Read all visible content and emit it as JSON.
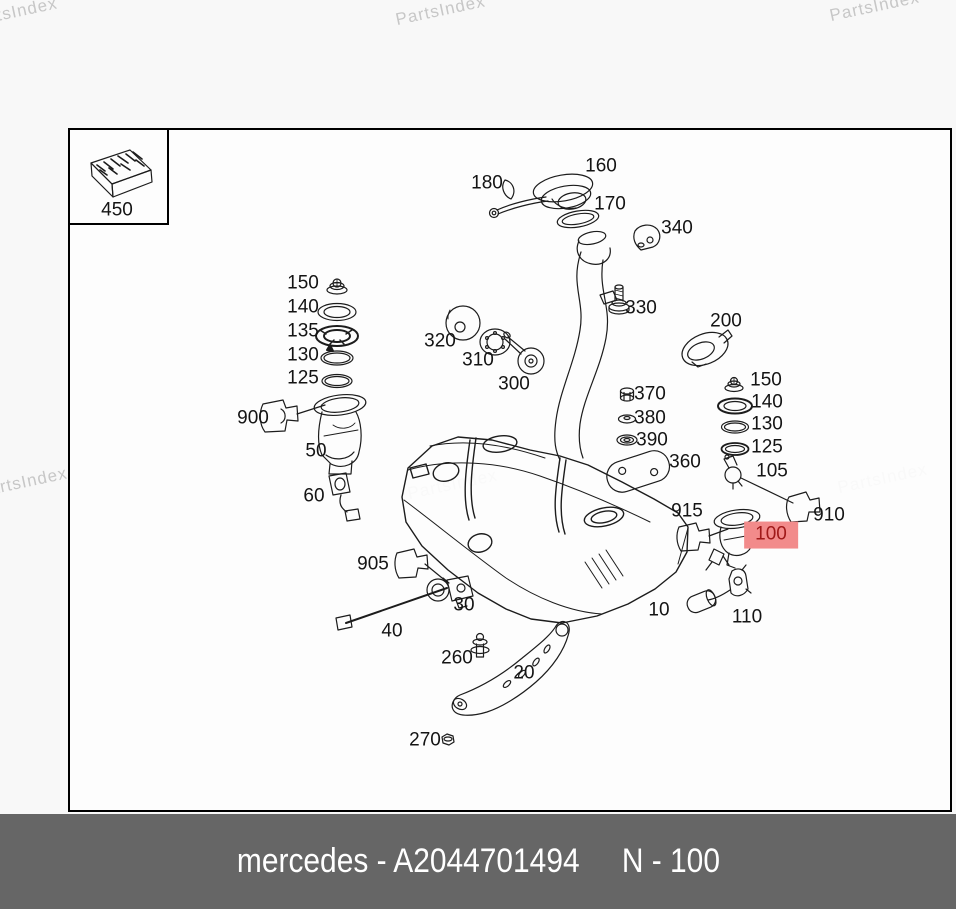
{
  "watermarks": {
    "text": "PartsIndex",
    "color": "#c7c7c7",
    "positions": [
      {
        "x": -30,
        "y": 12
      },
      {
        "x": 398,
        "y": 10
      },
      {
        "x": 832,
        "y": 6
      },
      {
        "x": -20,
        "y": 482
      },
      {
        "x": 410,
        "y": 484
      },
      {
        "x": 840,
        "y": 478
      }
    ]
  },
  "footer": {
    "left_text": "mercedes - A2044701494",
    "right_text": "N - 100",
    "background": "#666666",
    "text_color": "#ffffff"
  },
  "diagram": {
    "highlight": {
      "background": "#f28b8b",
      "text_color": "#a01a1a"
    },
    "labels": [
      {
        "id": "450",
        "text": "450",
        "x": 117,
        "y": 211
      },
      {
        "id": "180",
        "text": "180",
        "x": 487,
        "y": 184
      },
      {
        "id": "160",
        "text": "160",
        "x": 601,
        "y": 167
      },
      {
        "id": "170",
        "text": "170",
        "x": 610,
        "y": 205
      },
      {
        "id": "340",
        "text": "340",
        "x": 677,
        "y": 229
      },
      {
        "id": "150-left",
        "text": "150",
        "x": 303,
        "y": 284
      },
      {
        "id": "140-left",
        "text": "140",
        "x": 303,
        "y": 308
      },
      {
        "id": "135-left",
        "text": "135",
        "x": 303,
        "y": 332
      },
      {
        "id": "130-left",
        "text": "130",
        "x": 303,
        "y": 356
      },
      {
        "id": "125-left",
        "text": "125",
        "x": 303,
        "y": 379
      },
      {
        "id": "320",
        "text": "320",
        "x": 440,
        "y": 342
      },
      {
        "id": "310",
        "text": "310",
        "x": 478,
        "y": 361
      },
      {
        "id": "300",
        "text": "300",
        "x": 514,
        "y": 385
      },
      {
        "id": "330",
        "text": "330",
        "x": 641,
        "y": 309
      },
      {
        "id": "200",
        "text": "200",
        "x": 726,
        "y": 322
      },
      {
        "id": "370",
        "text": "370",
        "x": 650,
        "y": 395
      },
      {
        "id": "380",
        "text": "380",
        "x": 650,
        "y": 419
      },
      {
        "id": "390",
        "text": "390",
        "x": 652,
        "y": 441
      },
      {
        "id": "150-right",
        "text": "150",
        "x": 766,
        "y": 381
      },
      {
        "id": "140-right",
        "text": "140",
        "x": 767,
        "y": 403
      },
      {
        "id": "130-right",
        "text": "130",
        "x": 767,
        "y": 425
      },
      {
        "id": "125-right",
        "text": "125",
        "x": 767,
        "y": 448
      },
      {
        "id": "105",
        "text": "105",
        "x": 772,
        "y": 472
      },
      {
        "id": "900",
        "text": "900",
        "x": 253,
        "y": 419
      },
      {
        "id": "50",
        "text": "50",
        "x": 316,
        "y": 452
      },
      {
        "id": "360",
        "text": "360",
        "x": 685,
        "y": 463
      },
      {
        "id": "60",
        "text": "60",
        "x": 314,
        "y": 497
      },
      {
        "id": "915",
        "text": "915",
        "x": 687,
        "y": 512
      },
      {
        "id": "910",
        "text": "910",
        "x": 829,
        "y": 516
      },
      {
        "id": "100",
        "text": "100",
        "x": 771,
        "y": 535,
        "highlighted": true
      },
      {
        "id": "905",
        "text": "905",
        "x": 373,
        "y": 565
      },
      {
        "id": "30",
        "text": "30",
        "x": 464,
        "y": 606
      },
      {
        "id": "10",
        "text": "10",
        "x": 659,
        "y": 611
      },
      {
        "id": "40",
        "text": "40",
        "x": 392,
        "y": 632
      },
      {
        "id": "110",
        "text": "110",
        "x": 747,
        "y": 618
      },
      {
        "id": "260",
        "text": "260",
        "x": 457,
        "y": 659
      },
      {
        "id": "20",
        "text": "20",
        "x": 524,
        "y": 674
      },
      {
        "id": "270",
        "text": "270",
        "x": 425,
        "y": 741
      }
    ]
  }
}
